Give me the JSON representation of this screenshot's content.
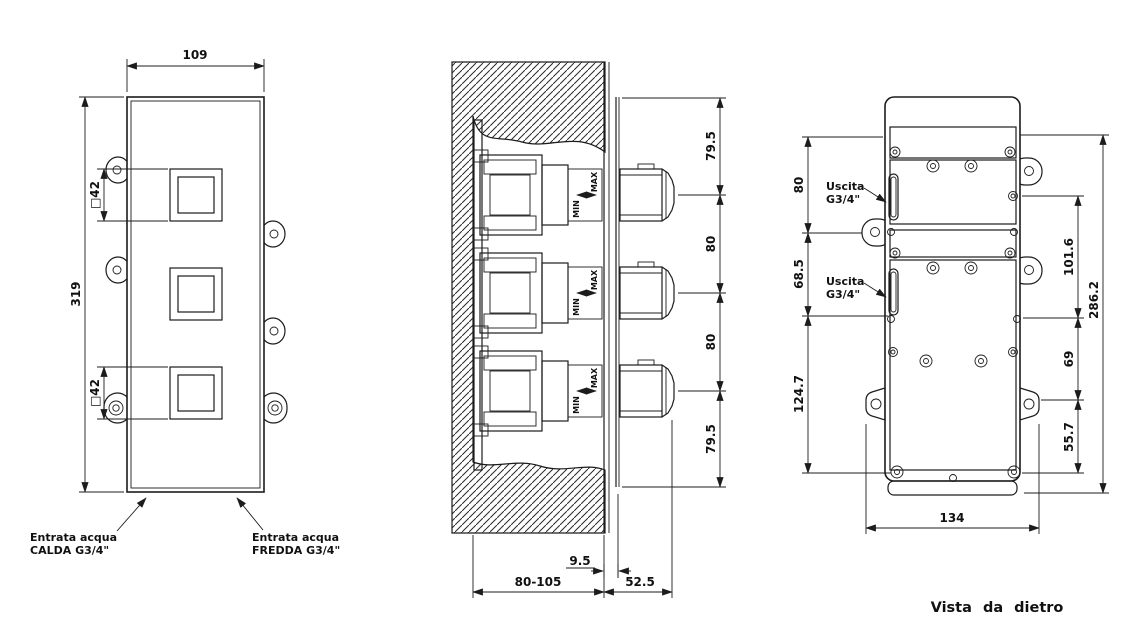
{
  "front_view": {
    "dim_width": "109",
    "dim_height": "319",
    "dim_knob_top": "□42",
    "dim_knob_bottom": "□42",
    "label_hot_1": "Entrata acqua",
    "label_hot_2": "CALDA G3/4\"",
    "label_cold_1": "Entrata acqua",
    "label_cold_2": "FREDDA G3/4\""
  },
  "section_view": {
    "dim_seg_1": "79.5",
    "dim_seg_2": "80",
    "dim_seg_3": "80",
    "dim_seg_4": "79.5",
    "label_min": "MIN",
    "label_max": "MAX",
    "dim_plate": "9.5",
    "dim_wall_depth": "80-105",
    "dim_protrusion": "52.5"
  },
  "rear_view": {
    "dim_left_1": "80",
    "dim_left_2": "68.5",
    "dim_left_3": "124.7",
    "dim_right_1": "101.6",
    "dim_right_2": "69",
    "dim_right_3": "55.7",
    "dim_right_total": "286.2",
    "dim_width": "134",
    "label_outlet_1_line1": "Uscita",
    "label_outlet_1_line2": "G3/4\"",
    "label_outlet_2_line1": "Uscita",
    "label_outlet_2_line2": "G3/4\"",
    "caption": "Vista da dietro"
  }
}
